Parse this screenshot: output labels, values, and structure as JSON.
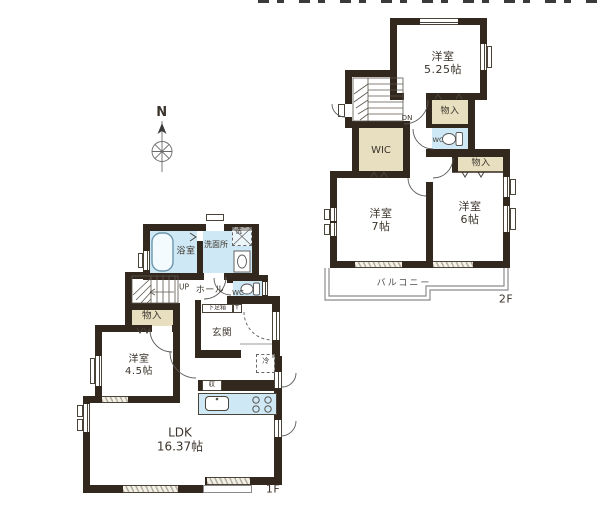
{
  "compass": {
    "north": "N"
  },
  "floor2": {
    "label": "2F",
    "room_525": {
      "name": "洋室",
      "size": "5.25帖"
    },
    "stairs_down": "DN",
    "closet_top": "物入",
    "wc": "WC",
    "wic": "WIC",
    "closet_side": "物入",
    "room_7": {
      "name": "洋室",
      "size": "7帖"
    },
    "room_6": {
      "name": "洋室",
      "size": "6帖"
    },
    "balcony": "バルコニー"
  },
  "floor1": {
    "label": "1F",
    "bath": "浴室",
    "washroom": "洗面所",
    "washer": "洗",
    "stairs_up": "UP",
    "hall": "ホール",
    "wc": "WC",
    "closet": "物入",
    "shoe_box": "下足箱",
    "shoe_box_t": "T",
    "entrance": "玄関",
    "fridge": "冷",
    "room_45": {
      "name": "洋室",
      "size": "4.5帖"
    },
    "kitchen_storage": "収",
    "ldk": {
      "name": "LDK",
      "size": "16.37帖"
    }
  },
  "colors": {
    "wall": "#33281e",
    "wet_area": "#cfe8f5",
    "closet": "#e8dfc0",
    "background": "#ffffff"
  }
}
